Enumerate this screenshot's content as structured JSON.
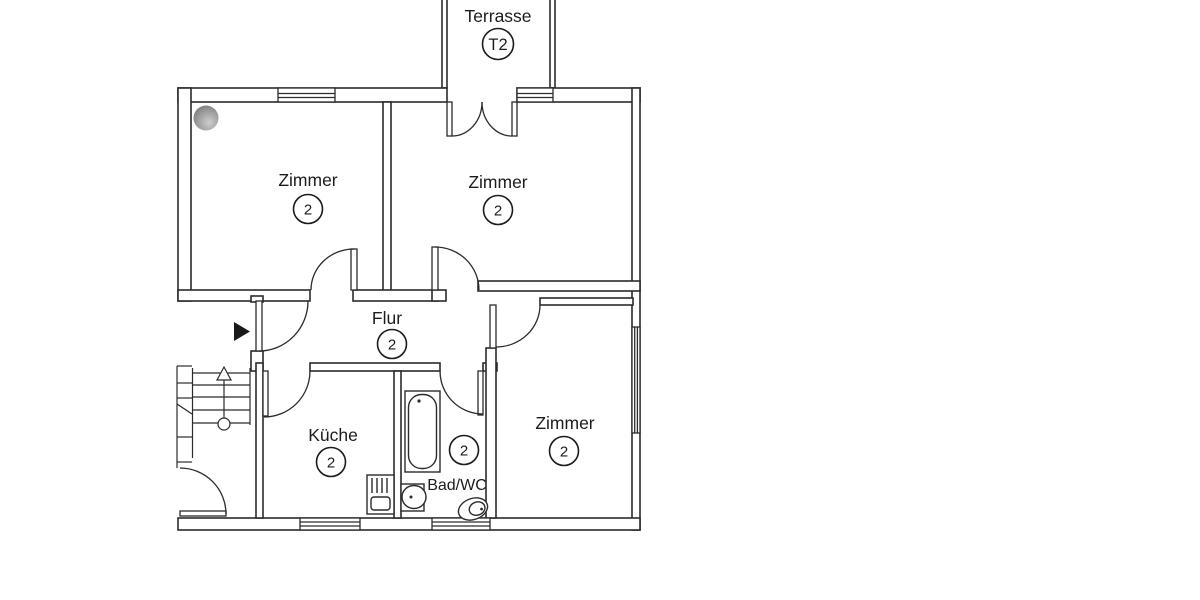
{
  "plan": {
    "terrace": {
      "label": "Terrasse",
      "number": "T2"
    },
    "rooms": [
      {
        "id": "zimmer-top-left",
        "label": "Zimmer",
        "number": "2"
      },
      {
        "id": "zimmer-top-right",
        "label": "Zimmer",
        "number": "2"
      },
      {
        "id": "flur",
        "label": "Flur",
        "number": "2"
      },
      {
        "id": "kueche",
        "label": "Küche",
        "number": "2"
      },
      {
        "id": "bad-wc",
        "label": "Bad/WC",
        "number": "2"
      },
      {
        "id": "zimmer-bottom-right",
        "label": "Zimmer",
        "number": "2"
      }
    ],
    "icons": {
      "entrance_arrow": "right-triangle",
      "stair_direction": "up-arrow"
    },
    "colors": {
      "line": "#2b2b2b",
      "background": "#ffffff",
      "ceiling_marker": "#8a8a8a"
    }
  }
}
